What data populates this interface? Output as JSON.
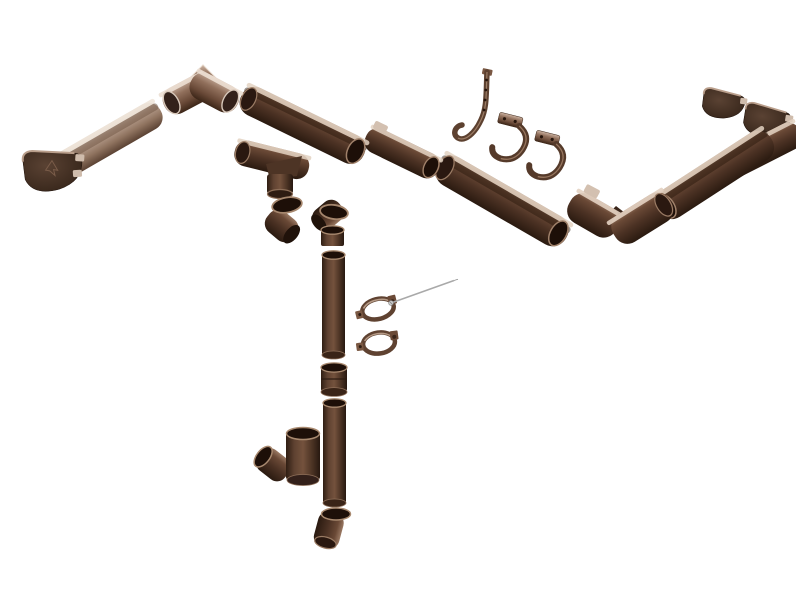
{
  "image": {
    "kind": "exploded-parts-rendering",
    "subject": "Half-round rain gutter and round downpipe system components",
    "background_color": "#ffffff",
    "palette": {
      "dark_brown": "#4c3224",
      "medium_brown": "#6a4a38",
      "light_taupe": "#9b8172",
      "edge_highlight": "#e8dccf",
      "interior_shadow": "#1d0f08",
      "metal_screw": "#a9a9a9"
    }
  },
  "parts": [
    {
      "name": "left end cap"
    },
    {
      "name": "left gutter section"
    },
    {
      "name": "inside 90 degree gutter corner"
    },
    {
      "name": "top gutter section a"
    },
    {
      "name": "top gutter section b with union clip"
    },
    {
      "name": "gutter outlet funnel"
    },
    {
      "name": "downpipe elbow a"
    },
    {
      "name": "downpipe elbow b"
    },
    {
      "name": "long rafter hook strap"
    },
    {
      "name": "gutter fascia hook a"
    },
    {
      "name": "gutter fascia hook b"
    },
    {
      "name": "right gutter section a"
    },
    {
      "name": "outside 90 degree gutter corner"
    },
    {
      "name": "right gutter section b"
    },
    {
      "name": "right gutter section c"
    },
    {
      "name": "right end cap a"
    },
    {
      "name": "right end cap b"
    },
    {
      "name": "downpipe socket"
    },
    {
      "name": "downpipe section a"
    },
    {
      "name": "downpipe coupler"
    },
    {
      "name": "downpipe section b"
    },
    {
      "name": "downpipe tee branch"
    },
    {
      "name": "downpipe outlet shoe"
    },
    {
      "name": "pipe clamp a"
    },
    {
      "name": "pipe clamp b"
    },
    {
      "name": "clamp mounting screw"
    }
  ]
}
